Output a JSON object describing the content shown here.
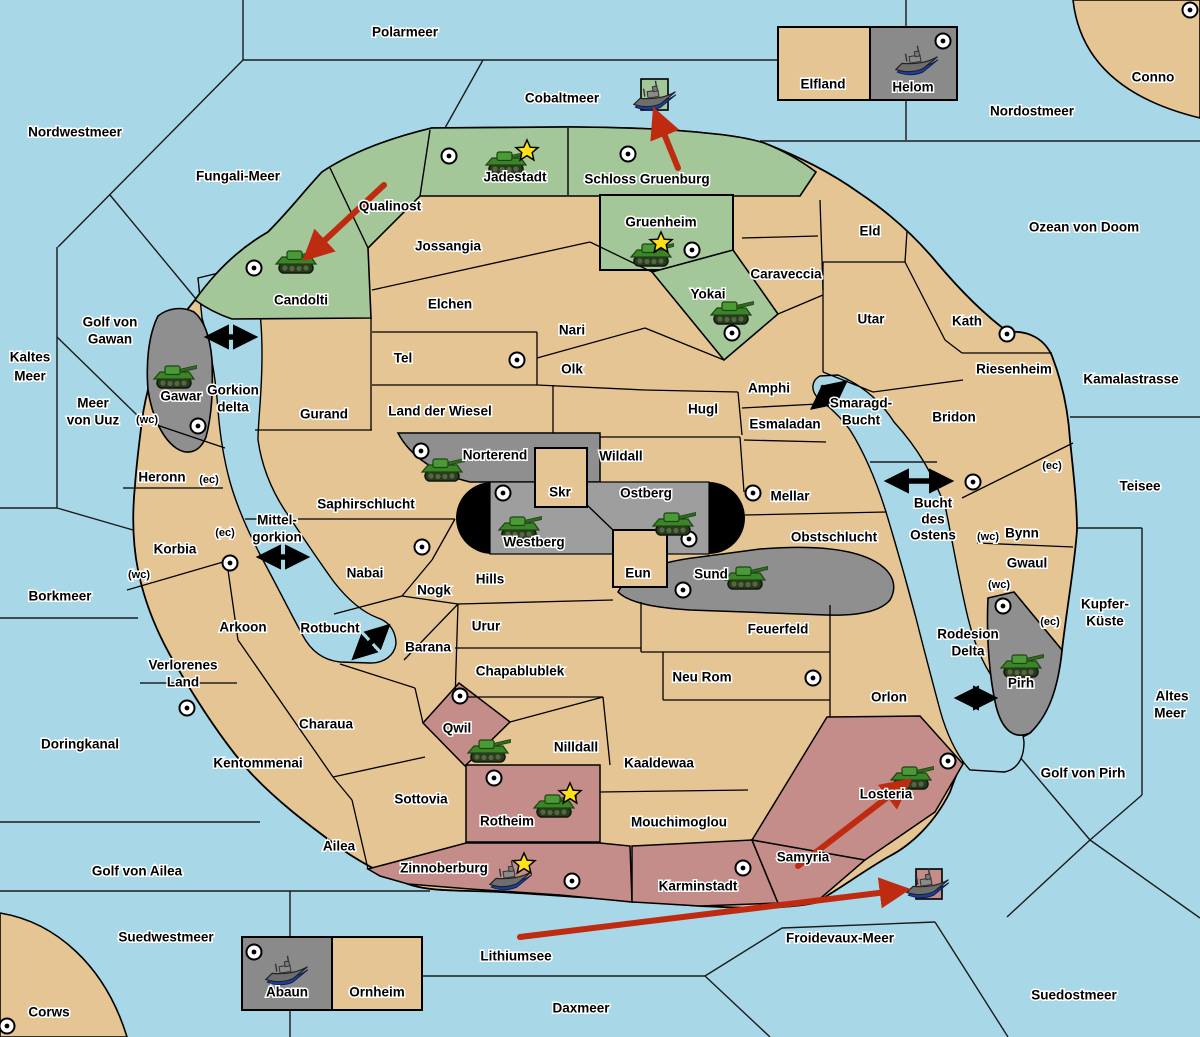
{
  "title": "Fantasy diplomacy wargame map",
  "palette": {
    "water": "#a8d8e8",
    "land_neutral": "#e5c594",
    "land_green": "#a4c79a",
    "land_gray": "#8f8f8f",
    "land_gray_light": "#9e9e9e",
    "land_pink": "#c48d89",
    "black_zone": "#000000",
    "border": "#000000",
    "move_arrow": "#bf2b10",
    "link_arrow": "#000000",
    "star": "#ffe01a",
    "ship_hull": "#6e6e6e",
    "ship_keel": "#1d3f9e",
    "tank_body": "#3c8428"
  },
  "map": {
    "sea_labels": [
      {
        "name": "Polarmeer",
        "x": 405,
        "y": 33
      },
      {
        "name": "Nordwestmeer",
        "x": 75,
        "y": 133
      },
      {
        "name": "Fungali-Meer",
        "x": 238,
        "y": 177
      },
      {
        "name": "Cobaltmeer",
        "x": 562,
        "y": 99
      },
      {
        "name": "Nordostmeer",
        "x": 1032,
        "y": 112
      },
      {
        "name": "Ozean von Doom",
        "x": 1084,
        "y": 228
      },
      {
        "name": "Kaltes",
        "x": 30,
        "y": 358
      },
      {
        "name": "Meer",
        "x": 30,
        "y": 377
      },
      {
        "name": "Golf von",
        "x": 110,
        "y": 323
      },
      {
        "name": "Gawan",
        "x": 110,
        "y": 340
      },
      {
        "name": "Meer",
        "x": 93,
        "y": 404
      },
      {
        "name": "von Uuz",
        "x": 93,
        "y": 421
      },
      {
        "name": "Gorkion",
        "x": 233,
        "y": 391
      },
      {
        "name": "delta",
        "x": 233,
        "y": 408
      },
      {
        "name": "Kamalastrasse",
        "x": 1131,
        "y": 380
      },
      {
        "name": "Teisee",
        "x": 1140,
        "y": 487
      },
      {
        "name": "Borkmeer",
        "x": 60,
        "y": 597
      },
      {
        "name": "Mittel-",
        "x": 277,
        "y": 521
      },
      {
        "name": "gorkion",
        "x": 277,
        "y": 538
      },
      {
        "name": "Rotbucht",
        "x": 330,
        "y": 629
      },
      {
        "name": "Smaragd-",
        "x": 861,
        "y": 404
      },
      {
        "name": "Bucht",
        "x": 861,
        "y": 421
      },
      {
        "name": "Bucht",
        "x": 933,
        "y": 504
      },
      {
        "name": "des",
        "x": 933,
        "y": 520
      },
      {
        "name": "Ostens",
        "x": 933,
        "y": 536
      },
      {
        "name": "Kupfer-",
        "x": 1105,
        "y": 605
      },
      {
        "name": "Küste",
        "x": 1105,
        "y": 622
      },
      {
        "name": "Altes",
        "x": 1172,
        "y": 697
      },
      {
        "name": "Meer",
        "x": 1170,
        "y": 714
      },
      {
        "name": "Rodesion",
        "x": 968,
        "y": 635
      },
      {
        "name": "Delta",
        "x": 968,
        "y": 652
      },
      {
        "name": "Golf von Pirh",
        "x": 1083,
        "y": 774
      },
      {
        "name": "Doringkanal",
        "x": 80,
        "y": 745
      },
      {
        "name": "Golf von Ailea",
        "x": 137,
        "y": 872
      },
      {
        "name": "Suedwestmeer",
        "x": 166,
        "y": 938
      },
      {
        "name": "Corws",
        "x": 49,
        "y": 1013
      },
      {
        "name": "Lithiumsee",
        "x": 516,
        "y": 957
      },
      {
        "name": "Daxmeer",
        "x": 581,
        "y": 1009
      },
      {
        "name": "Froidevaux-Meer",
        "x": 840,
        "y": 939
      },
      {
        "name": "Suedostmeer",
        "x": 1074,
        "y": 996
      },
      {
        "name": "Conno",
        "x": 1153,
        "y": 78
      }
    ],
    "territories": [
      {
        "name": "Jadestadt",
        "x": 515,
        "y": 178,
        "owner": "green"
      },
      {
        "name": "Schloss Gruenburg",
        "x": 647,
        "y": 180,
        "owner": "green"
      },
      {
        "name": "Qualinost",
        "x": 390,
        "y": 207,
        "owner": "green"
      },
      {
        "name": "Candolti",
        "x": 301,
        "y": 301,
        "owner": "green"
      },
      {
        "name": "Gruenheim",
        "x": 661,
        "y": 223,
        "owner": "green"
      },
      {
        "name": "Yokai",
        "x": 708,
        "y": 295,
        "owner": "green"
      },
      {
        "name": "Jossangia",
        "x": 448,
        "y": 247,
        "owner": "neutral"
      },
      {
        "name": "Elchen",
        "x": 450,
        "y": 305,
        "owner": "neutral"
      },
      {
        "name": "Nari",
        "x": 572,
        "y": 331,
        "owner": "neutral"
      },
      {
        "name": "Tel",
        "x": 403,
        "y": 359,
        "owner": "neutral"
      },
      {
        "name": "Olk",
        "x": 572,
        "y": 370,
        "owner": "neutral"
      },
      {
        "name": "Land der Wiesel",
        "x": 440,
        "y": 412,
        "owner": "neutral"
      },
      {
        "name": "Gurand",
        "x": 324,
        "y": 415,
        "owner": "neutral"
      },
      {
        "name": "Hugl",
        "x": 703,
        "y": 410,
        "owner": "neutral"
      },
      {
        "name": "Caraveccia",
        "x": 786,
        "y": 275,
        "owner": "neutral"
      },
      {
        "name": "Eld",
        "x": 870,
        "y": 232,
        "owner": "neutral"
      },
      {
        "name": "Utar",
        "x": 871,
        "y": 320,
        "owner": "neutral"
      },
      {
        "name": "Kath",
        "x": 967,
        "y": 322,
        "owner": "neutral"
      },
      {
        "name": "Riesenheim",
        "x": 1014,
        "y": 370,
        "owner": "neutral"
      },
      {
        "name": "Amphi",
        "x": 769,
        "y": 389,
        "owner": "neutral"
      },
      {
        "name": "Esmaladan",
        "x": 785,
        "y": 425,
        "owner": "neutral"
      },
      {
        "name": "Bridon",
        "x": 954,
        "y": 418,
        "owner": "neutral"
      },
      {
        "name": "Wildall",
        "x": 621,
        "y": 457,
        "owner": "neutral"
      },
      {
        "name": "Skr",
        "x": 560,
        "y": 493,
        "owner": "neutral"
      },
      {
        "name": "Mellar",
        "x": 790,
        "y": 497,
        "owner": "neutral"
      },
      {
        "name": "Obstschlucht",
        "x": 834,
        "y": 538,
        "owner": "neutral"
      },
      {
        "name": "Saphirschlucht",
        "x": 366,
        "y": 505,
        "owner": "neutral"
      },
      {
        "name": "Heronn",
        "x": 162,
        "y": 478,
        "owner": "neutral"
      },
      {
        "name": "Korbia",
        "x": 175,
        "y": 550,
        "owner": "neutral"
      },
      {
        "name": "Hills",
        "x": 490,
        "y": 580,
        "owner": "neutral"
      },
      {
        "name": "Eun",
        "x": 638,
        "y": 574,
        "owner": "neutral"
      },
      {
        "name": "Nabai",
        "x": 365,
        "y": 574,
        "owner": "neutral"
      },
      {
        "name": "Nogk",
        "x": 434,
        "y": 591,
        "owner": "neutral"
      },
      {
        "name": "Urur",
        "x": 486,
        "y": 627,
        "owner": "neutral"
      },
      {
        "name": "Barana",
        "x": 428,
        "y": 648,
        "owner": "neutral"
      },
      {
        "name": "Chapablublek",
        "x": 520,
        "y": 672,
        "owner": "neutral"
      },
      {
        "name": "Feuerfeld",
        "x": 778,
        "y": 630,
        "owner": "neutral"
      },
      {
        "name": "Neu Rom",
        "x": 702,
        "y": 678,
        "owner": "neutral"
      },
      {
        "name": "Orlon",
        "x": 889,
        "y": 698,
        "owner": "neutral"
      },
      {
        "name": "Verlorenes",
        "x": 183,
        "y": 666,
        "owner": "neutral"
      },
      {
        "name": "Land",
        "x": 183,
        "y": 683,
        "owner": "neutral"
      },
      {
        "name": "Arkoon",
        "x": 243,
        "y": 628,
        "owner": "neutral"
      },
      {
        "name": "Kentommenai",
        "x": 258,
        "y": 764,
        "owner": "neutral"
      },
      {
        "name": "Charaua",
        "x": 326,
        "y": 725,
        "owner": "neutral"
      },
      {
        "name": "Sottovia",
        "x": 421,
        "y": 800,
        "owner": "neutral"
      },
      {
        "name": "Ailea",
        "x": 339,
        "y": 847,
        "owner": "neutral"
      },
      {
        "name": "Nilldall",
        "x": 576,
        "y": 748,
        "owner": "neutral"
      },
      {
        "name": "Kaaldewaa",
        "x": 659,
        "y": 764,
        "owner": "neutral"
      },
      {
        "name": "Mouchimoglou",
        "x": 679,
        "y": 823,
        "owner": "neutral"
      },
      {
        "name": "Bynn",
        "x": 1022,
        "y": 534,
        "owner": "neutral"
      },
      {
        "name": "Gwaul",
        "x": 1027,
        "y": 564,
        "owner": "neutral"
      },
      {
        "name": "Elfland",
        "x": 823,
        "y": 85,
        "owner": "neutral"
      },
      {
        "name": "Ornheim",
        "x": 377,
        "y": 993,
        "owner": "neutral"
      },
      {
        "name": "Gawar",
        "x": 181,
        "y": 397,
        "owner": "gray"
      },
      {
        "name": "Norterend",
        "x": 495,
        "y": 456,
        "owner": "gray"
      },
      {
        "name": "Westberg",
        "x": 534,
        "y": 543,
        "owner": "gray"
      },
      {
        "name": "Ostberg",
        "x": 646,
        "y": 494,
        "owner": "gray"
      },
      {
        "name": "Sund",
        "x": 711,
        "y": 575,
        "owner": "gray"
      },
      {
        "name": "Pirh",
        "x": 1021,
        "y": 684,
        "owner": "gray"
      },
      {
        "name": "Helom",
        "x": 913,
        "y": 88,
        "owner": "gray"
      },
      {
        "name": "Abaun",
        "x": 287,
        "y": 993,
        "owner": "gray"
      },
      {
        "name": "Qwil",
        "x": 457,
        "y": 729,
        "owner": "pink"
      },
      {
        "name": "Rotheim",
        "x": 507,
        "y": 822,
        "owner": "pink"
      },
      {
        "name": "Zinnoberburg",
        "x": 444,
        "y": 869,
        "owner": "pink"
      },
      {
        "name": "Karminstadt",
        "x": 698,
        "y": 887,
        "owner": "pink"
      },
      {
        "name": "Samyria",
        "x": 803,
        "y": 858,
        "owner": "pink"
      },
      {
        "name": "Losteria",
        "x": 886,
        "y": 795,
        "owner": "pink"
      }
    ],
    "coast_tags": [
      {
        "name": "(wc)",
        "x": 147,
        "y": 420
      },
      {
        "name": "(ec)",
        "x": 209,
        "y": 480
      },
      {
        "name": "(ec)",
        "x": 225,
        "y": 533
      },
      {
        "name": "(wc)",
        "x": 139,
        "y": 575
      },
      {
        "name": "(ec)",
        "x": 1052,
        "y": 466
      },
      {
        "name": "(wc)",
        "x": 988,
        "y": 537
      },
      {
        "name": "(wc)",
        "x": 999,
        "y": 585
      },
      {
        "name": "(ec)",
        "x": 1050,
        "y": 622
      }
    ],
    "supply_centers": [
      [
        449,
        156
      ],
      [
        628,
        154
      ],
      [
        692,
        250
      ],
      [
        732,
        333
      ],
      [
        254,
        268
      ],
      [
        1190,
        10
      ],
      [
        943,
        41
      ],
      [
        517,
        360
      ],
      [
        198,
        426
      ],
      [
        230,
        563
      ],
      [
        421,
        451
      ],
      [
        503,
        493
      ],
      [
        689,
        539
      ],
      [
        683,
        590
      ],
      [
        422,
        547
      ],
      [
        753,
        493
      ],
      [
        1007,
        334
      ],
      [
        973,
        482
      ],
      [
        813,
        678
      ],
      [
        187,
        708
      ],
      [
        460,
        696
      ],
      [
        494,
        778
      ],
      [
        572,
        881
      ],
      [
        743,
        868
      ],
      [
        948,
        761
      ],
      [
        1003,
        606
      ],
      [
        254,
        952
      ],
      [
        7,
        1026
      ]
    ],
    "units": {
      "tanks": [
        [
          507,
          163
        ],
        [
          297,
          262
        ],
        [
          652,
          255
        ],
        [
          732,
          313
        ],
        [
          175,
          377
        ],
        [
          443,
          470
        ],
        [
          520,
          528
        ],
        [
          674,
          524
        ],
        [
          746,
          578
        ],
        [
          489,
          751
        ],
        [
          555,
          806
        ],
        [
          912,
          778
        ],
        [
          1022,
          666
        ]
      ],
      "ships": [
        [
          655,
          97
        ],
        [
          917,
          62
        ],
        [
          287,
          972
        ],
        [
          511,
          877
        ],
        [
          928,
          885
        ]
      ]
    },
    "stars": [
      [
        527,
        151
      ],
      [
        661,
        243
      ],
      [
        570,
        794
      ],
      [
        524,
        864
      ]
    ],
    "link_arrows": [
      [
        210,
        337,
        252,
        337
      ],
      [
        262,
        557,
        304,
        557
      ],
      [
        356,
        656,
        386,
        628
      ],
      [
        815,
        406,
        843,
        384
      ],
      [
        890,
        481,
        948,
        481
      ],
      [
        960,
        698,
        992,
        698
      ]
    ],
    "move_arrows": [
      [
        384,
        185,
        308,
        256
      ],
      [
        678,
        168,
        656,
        114
      ],
      [
        798,
        866,
        906,
        783
      ],
      [
        520,
        937,
        903,
        890
      ]
    ]
  }
}
